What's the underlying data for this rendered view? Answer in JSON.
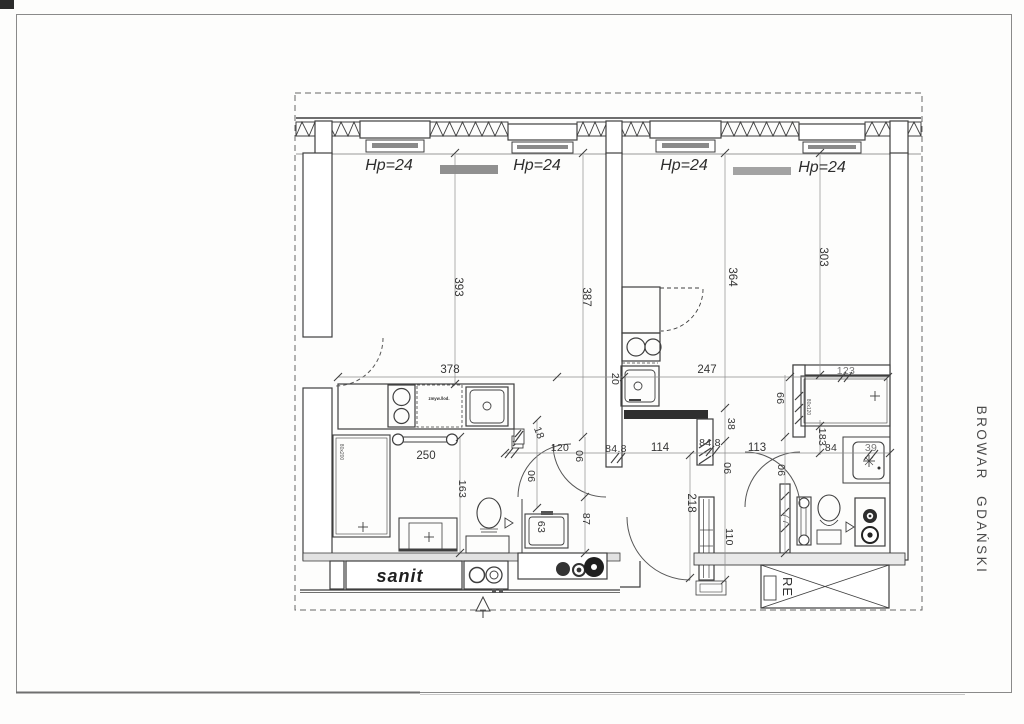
{
  "sheet": {
    "project_name_vertical": "BROWAR GDAŃSKI"
  },
  "parapet_labels": {
    "a": "Hp=24",
    "b": "Hp=24",
    "c": "Hp=24",
    "d": "Hp=24"
  },
  "annotations": {
    "sanit": "sanit",
    "re": "RE",
    "bed_left_size": "80x200",
    "bed_right_size": "80x120",
    "kitchen_appliance": "zmyw./lod."
  },
  "dimensions": {
    "d393": "393",
    "d387": "387",
    "d364": "364",
    "d303": "303",
    "d378": "378",
    "d20": "20",
    "d247": "247",
    "d123": "123",
    "d250": "250",
    "d163": "163",
    "d18": "18",
    "d120": "120",
    "d90a": "90",
    "d90b": "90",
    "d90c": "90",
    "d90d": "90",
    "d848a": "84.8",
    "d114": "114",
    "d848b": "84.8",
    "d113": "113",
    "d38": "38",
    "d99": "99",
    "d183": "183",
    "d84": "84",
    "d39": "39",
    "d87": "87",
    "d63": "63",
    "d218": "218",
    "d110": "110",
    "d77": "77"
  }
}
